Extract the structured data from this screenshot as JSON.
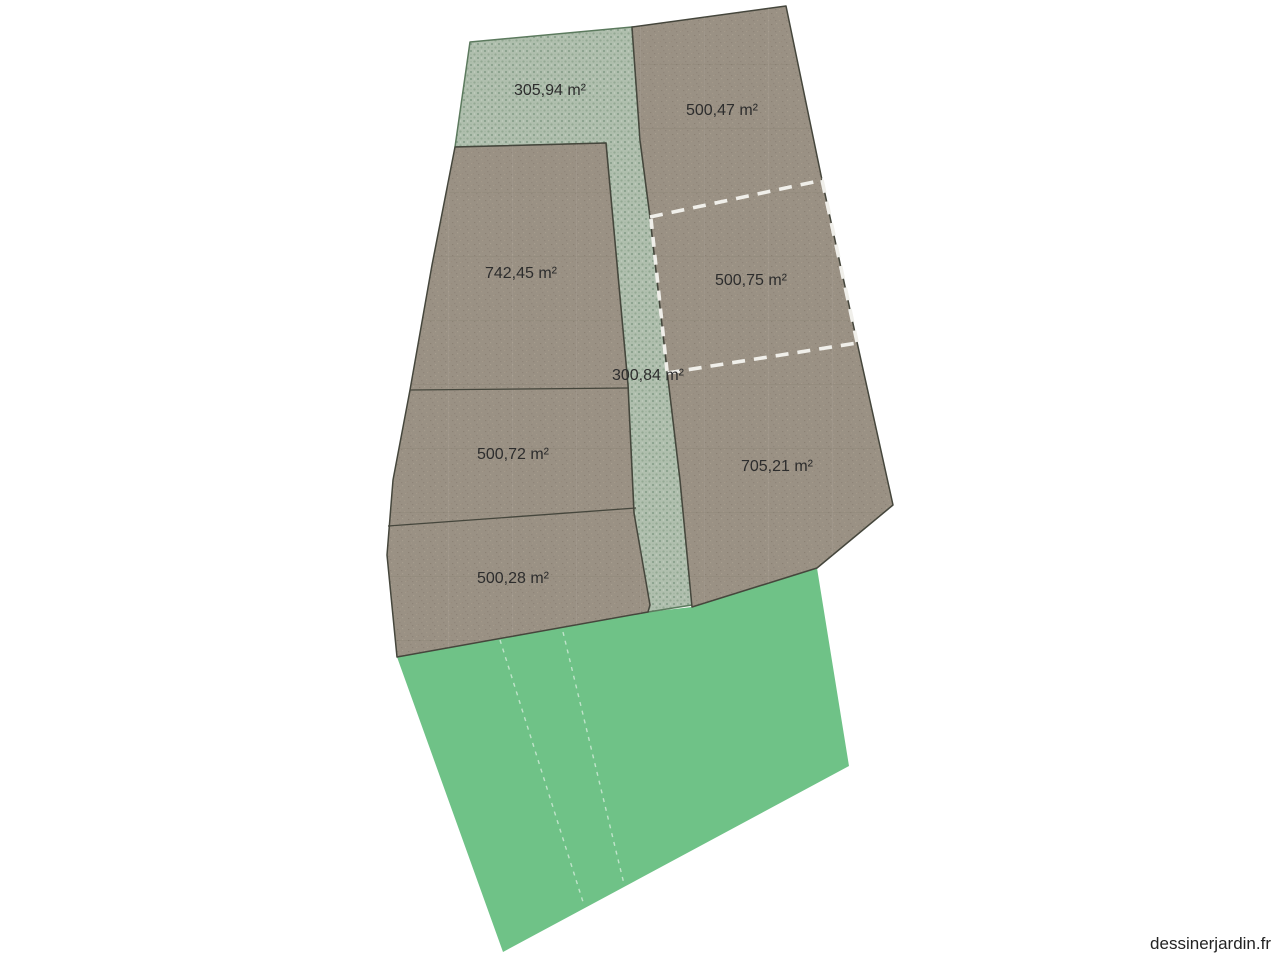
{
  "app": {
    "watermark": "dessinerjardin.fr"
  },
  "canvas": {
    "width": 1280,
    "height": 960,
    "background": "#ffffff"
  },
  "palette": {
    "parcel_soil_fill": "#9a9184",
    "hedge_fill": "#b0bfae",
    "hedge_weave": "#8ba28e",
    "lawn_fill": "#6fc287",
    "boundary_line": "#45463c",
    "dashed_line_white": "#f0efea",
    "label_color": "#2d2d2d"
  },
  "parcels": [
    {
      "name": "hedge-top",
      "surface": "hedge",
      "area_label": "305,94 m²"
    },
    {
      "name": "parcel-north-east",
      "surface": "soil",
      "area_label": "500,47 m²"
    },
    {
      "name": "parcel-west-large",
      "surface": "soil",
      "area_label": "742,45 m²"
    },
    {
      "name": "parcel-east-middle",
      "surface": "soil",
      "area_label": "500,75 m²",
      "border": "dashed"
    },
    {
      "name": "hedge-path",
      "surface": "hedge",
      "area_label": "300,84 m²"
    },
    {
      "name": "parcel-west-middle",
      "surface": "soil",
      "area_label": "500,72 m²"
    },
    {
      "name": "parcel-south-east",
      "surface": "soil",
      "area_label": "705,21 m²"
    },
    {
      "name": "parcel-west-lower",
      "surface": "soil",
      "area_label": "500,28 m²"
    },
    {
      "name": "lawn-south",
      "surface": "lawn",
      "area_label": ""
    }
  ]
}
